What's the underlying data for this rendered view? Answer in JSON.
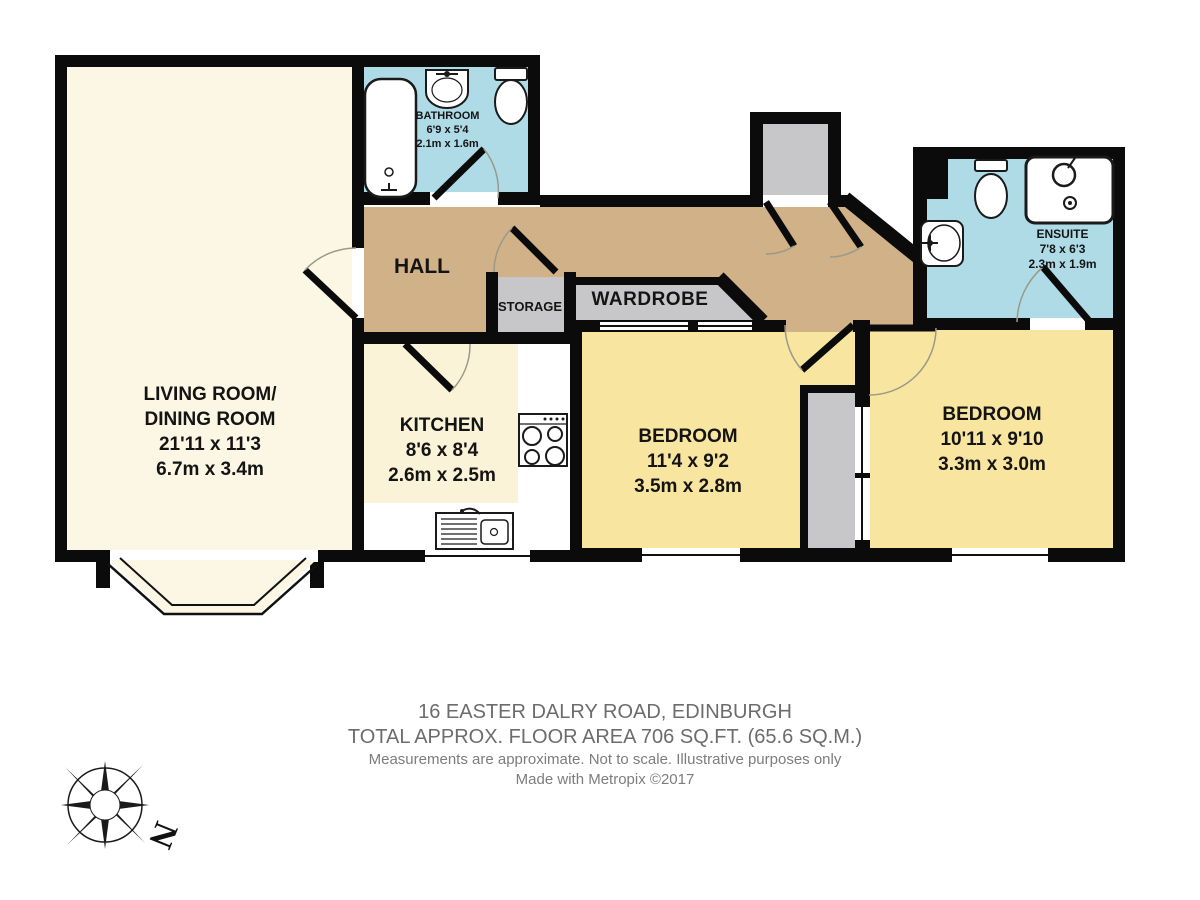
{
  "footer": {
    "address": "16 EASTER DALRY ROAD, EDINBURGH",
    "area": "TOTAL APPROX. FLOOR AREA 706 SQ.FT. (65.6 SQ.M.)",
    "disclaimer": "Measurements are approximate.  Not to scale.  Illustrative purposes only",
    "credit": "Made with Metropix ©2017"
  },
  "compass": {
    "north_label": "N"
  },
  "rooms": {
    "living": {
      "name1": "LIVING ROOM/",
      "name2": "DINING ROOM",
      "imperial": "21'11 x 11'3",
      "metric": "6.7m x 3.4m"
    },
    "kitchen": {
      "name": "KITCHEN",
      "imperial": "8'6 x 8'4",
      "metric": "2.6m x 2.5m"
    },
    "bathroom": {
      "name": "BATHROOM",
      "imperial": "6'9 x 5'4",
      "metric": "2.1m x 1.6m"
    },
    "ensuite": {
      "name": "ENSUITE",
      "imperial": "7'8 x 6'3",
      "metric": "2.3m x 1.9m"
    },
    "bedroom1": {
      "name": "BEDROOM",
      "imperial": "11'4 x 9'2",
      "metric": "3.5m x 2.8m"
    },
    "bedroom2": {
      "name": "BEDROOM",
      "imperial": "10'11 x 9'10",
      "metric": "3.3m x 3.0m"
    },
    "hall": {
      "name": "HALL"
    },
    "storage": {
      "name": "STORAGE"
    },
    "wardrobe": {
      "name": "WARDROBE"
    }
  },
  "colors": {
    "wall": "#0b0b0b",
    "living": "#FBF7E4",
    "kitchen": "#FAF3D8",
    "bedroom": "#F8E59F",
    "hall": "#D0B188",
    "bathroom": "#AFDBE7",
    "storage_gray": "#C7C7C9",
    "footer_text": "#6c6c6c"
  }
}
